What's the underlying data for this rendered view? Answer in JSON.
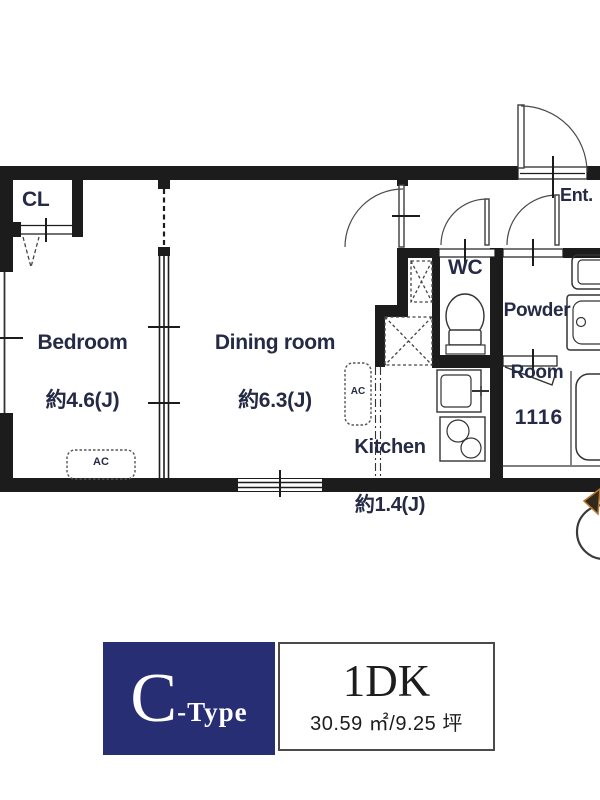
{
  "colors": {
    "wall": "#1c1c1c",
    "label_text": "#252a45",
    "accent_navy": "#272e74",
    "compass_accent": "#b5762e"
  },
  "plan": {
    "closet_label": "CL",
    "bedroom_name": "Bedroom",
    "bedroom_size": "約4.6(J)",
    "dining_name": "Dining room",
    "dining_size": "約6.3(J)",
    "kitchen_name": "Kitchen",
    "kitchen_size": "約1.4(J)",
    "wc_label": "WC",
    "powder_line1": "Powder",
    "powder_line2": "Room",
    "entrance_label": "Ent.",
    "bath_unit_label": "1116",
    "ac_label": "AC"
  },
  "type_card": {
    "type_letter": "C",
    "type_suffix": "-Type",
    "layout_type": "1DK",
    "area_text": "30.59 ㎡/9.25 坪"
  }
}
